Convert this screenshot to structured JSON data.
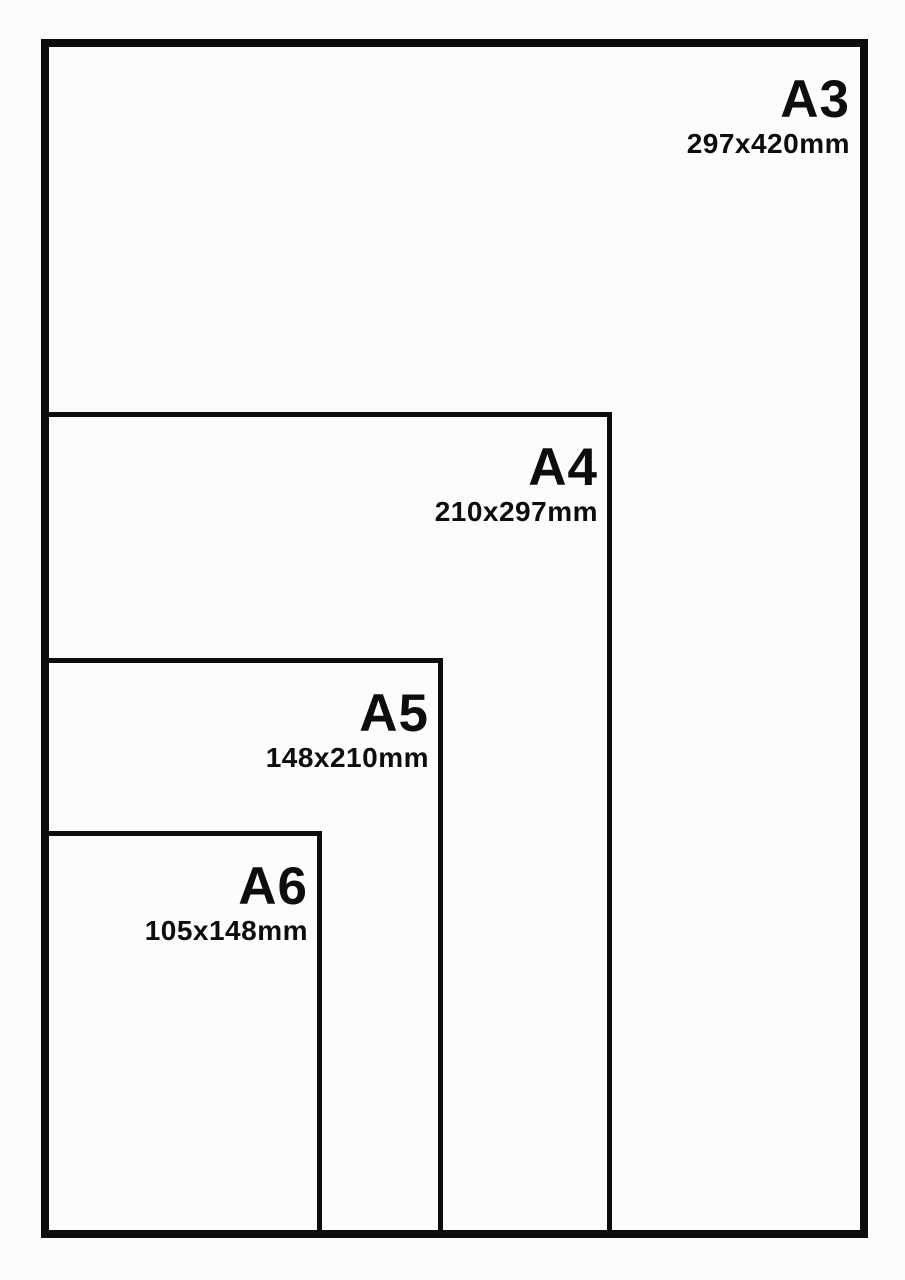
{
  "diagram": {
    "background": "#fcfcfc",
    "line_color": "#0d0d0d"
  },
  "sizes": [
    {
      "name": "A3",
      "dimensions": "297x420mm"
    },
    {
      "name": "A4",
      "dimensions": "210x297mm"
    },
    {
      "name": "A5",
      "dimensions": "148x210mm"
    },
    {
      "name": "A6",
      "dimensions": "105x148mm"
    }
  ]
}
